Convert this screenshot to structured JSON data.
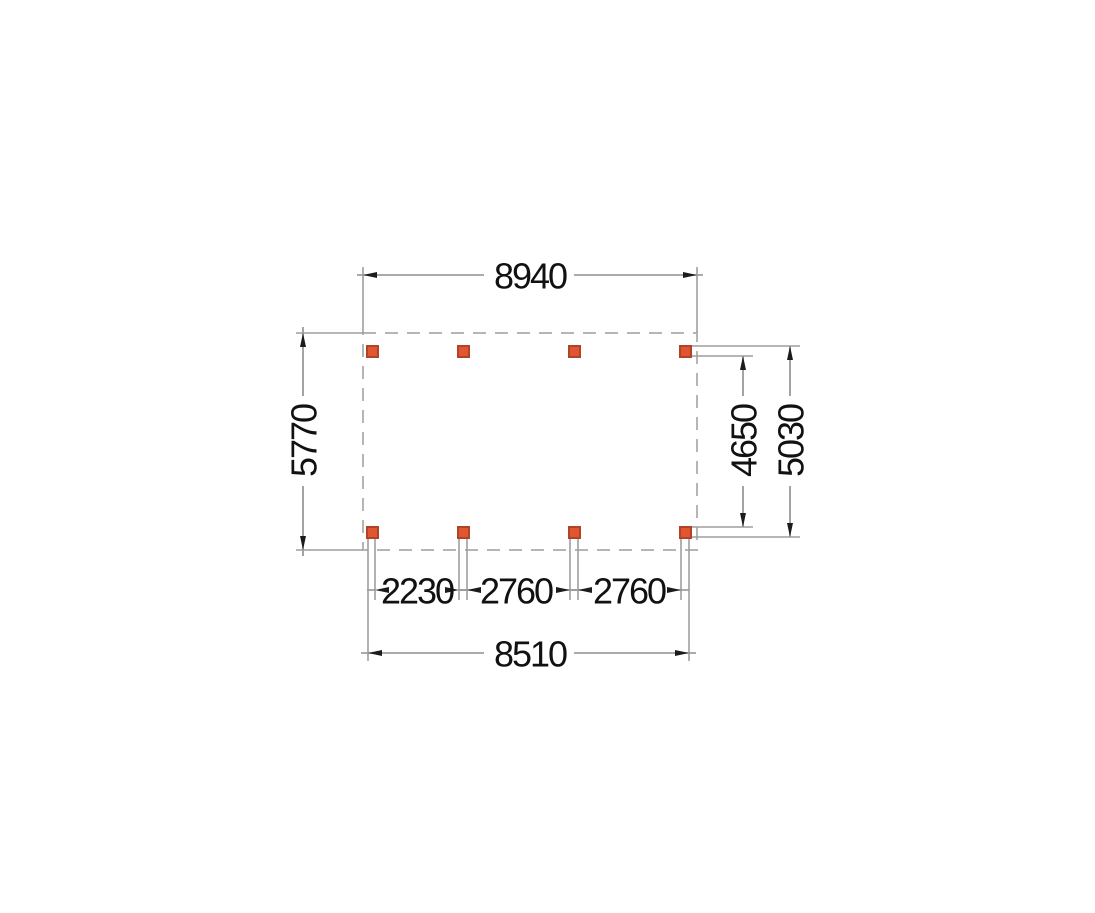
{
  "drawing": {
    "type": "floor-plan-top-view",
    "description": "foundation plan with 8 posts (2 rows x 4 columns) inside a dashed outline",
    "dim_labels": {
      "top_width": "8940",
      "left_depth": "5770",
      "right_inner_depth": "4650",
      "right_outer_depth": "5030",
      "bay_1": "2230",
      "bay_2": "2760",
      "bay_3": "2760",
      "bottom_post_span": "8510"
    },
    "posts": {
      "count": 8,
      "rows": 2,
      "columns": 4
    },
    "colors": {
      "background": "#ffffff",
      "outline_dashed": "#b5b5b5",
      "extension_line": "#9e9e9e",
      "dimension_line": "#8d8d8d",
      "arrow": "#1c1c1c",
      "text": "#111111",
      "post_fill": "#e15531",
      "post_stroke": "#b04428"
    }
  }
}
